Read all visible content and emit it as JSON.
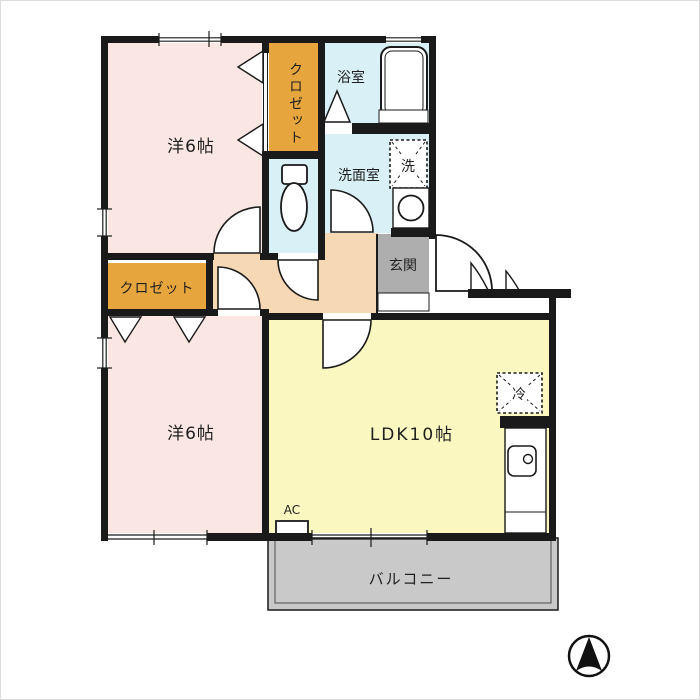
{
  "title": "2DK apartment floor plan",
  "colors": {
    "wall": "#1a1a1a",
    "bedroom_fill": "#fae7e3",
    "closet_fill": "#e7a53e",
    "wet_area_fill": "#d9f1f6",
    "hall_fill": "#f6d8b4",
    "genkan_fill": "#aeaeae",
    "ldk_fill": "#faf8c0",
    "balcony_fill": "#c9c9c9"
  },
  "labels": {
    "bedroom_top": "洋6帖",
    "bedroom_bottom": "洋6帖",
    "ldk": "LDK10帖",
    "closet_top": "クロゼット",
    "closet_left": "クロゼット",
    "bath": "浴室",
    "washroom": "洗面室",
    "washer": "洗",
    "genkan": "玄関",
    "fridge": "冷",
    "ac": "AC",
    "balcony": "バルコニー"
  }
}
